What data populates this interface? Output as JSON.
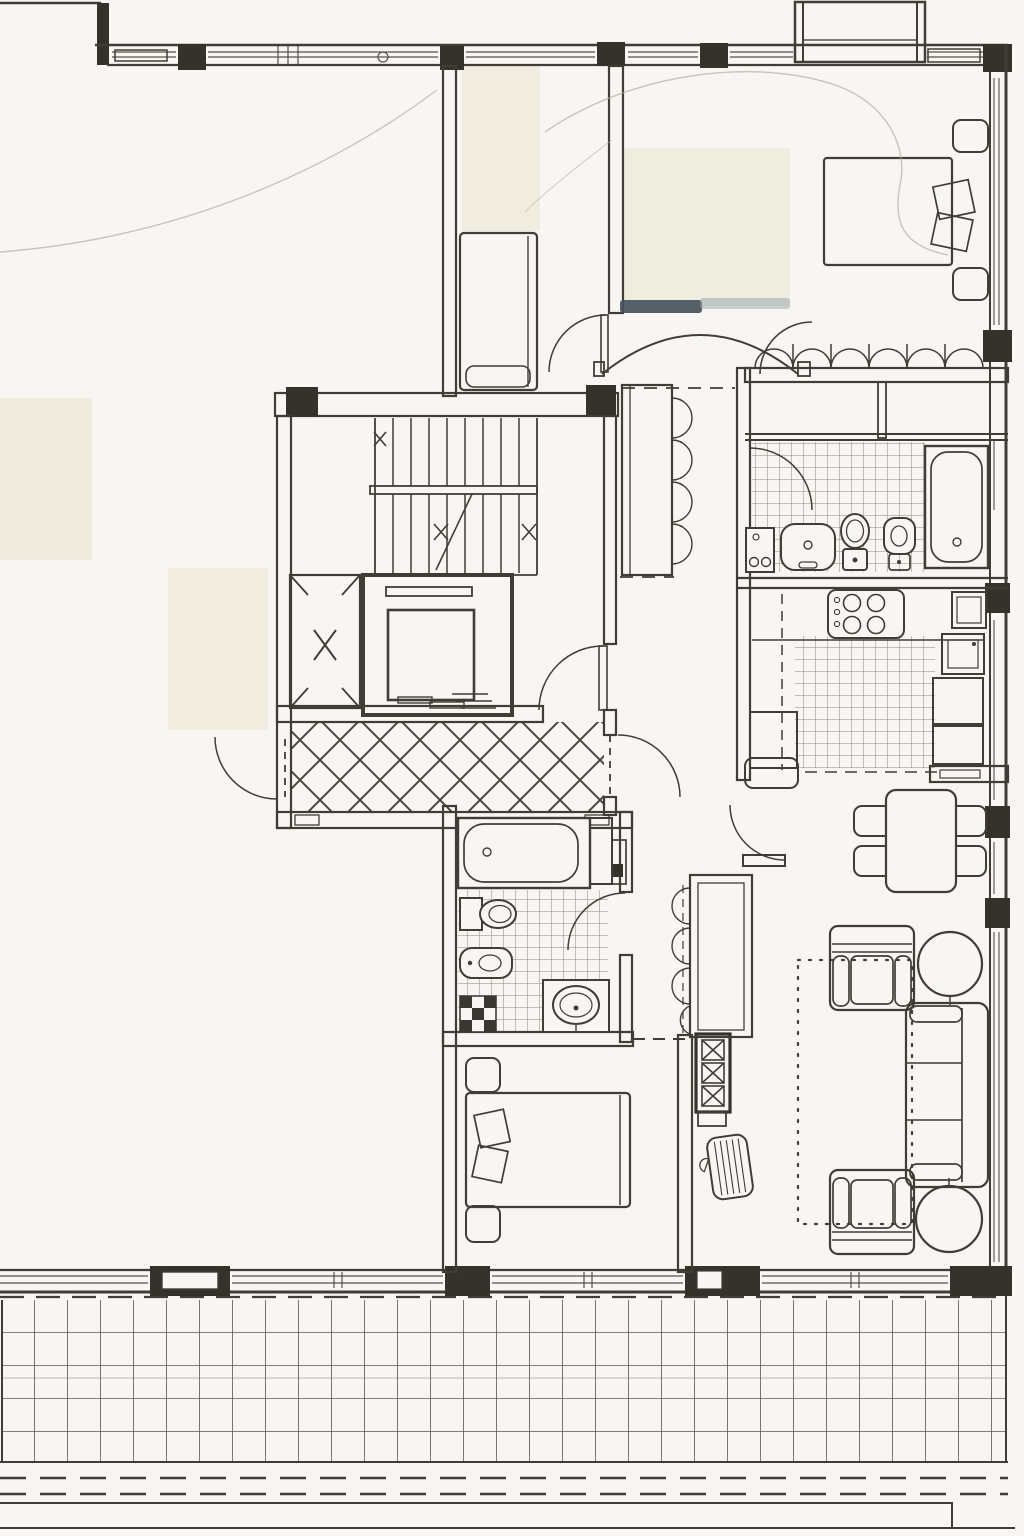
{
  "document": {
    "type": "architectural-floor-plan",
    "style": "black-and-white scanned blueprint, no text labels visible",
    "visible_text": [],
    "orientation": "apartment on right side, neighbouring unit erased to blank paper on left, tiled terrace across bottom"
  },
  "palette": {
    "paper": "#f7f6f2",
    "ink": "#413d36",
    "wall_fill": "#35322b",
    "tile_line": "#8a8578",
    "terrace_line": "#5c5850",
    "artifact_beige": "#edeadb",
    "smear_dark": "#44505b",
    "smear_light": "#98a2a6",
    "pencil_faint": "#b3afa3"
  },
  "rooms": [
    {
      "name": "stair-lobby",
      "floor": "diamond crosshatch tiles",
      "doors": 3
    },
    {
      "name": "staircase",
      "flights": 2,
      "treads_per_flight": 8,
      "landing": 1
    },
    {
      "name": "elevator",
      "parts": [
        "shaft",
        "car",
        "sliding-door",
        "counterweight",
        "sill-steps"
      ]
    },
    {
      "name": "upper-left-room",
      "furniture": [
        "wardrobe-or-bed"
      ]
    },
    {
      "name": "upper-right-bedroom",
      "furniture": [
        "double-bed",
        "two-pillows",
        "two-nightstands",
        "open-closet-hanging-rail"
      ]
    },
    {
      "name": "upper-bathroom",
      "fixtures": [
        "bathtub",
        "toilet",
        "bidet",
        "washbasin",
        "washing-machine"
      ],
      "floor": "small square tiles"
    },
    {
      "name": "kitchen",
      "fixtures": [
        "cooktop-4-burners",
        "sink",
        "fridge",
        "counter",
        "overhead-cabinet-dashed"
      ],
      "floor": "small square tiles"
    },
    {
      "name": "dining-area",
      "furniture": [
        "table",
        "four-chairs",
        "sideboard"
      ]
    },
    {
      "name": "living-room",
      "furniture": [
        "sofa-3-seats",
        "two-armchairs",
        "two-round-side-tables",
        "tv-unit-3-bays",
        "magazine-rack",
        "dotted-rug"
      ]
    },
    {
      "name": "lower-bathroom",
      "fixtures": [
        "bathtub",
        "toilet",
        "bidet",
        "vanity-washbasin",
        "checker-drain",
        "water-heater"
      ],
      "floor": "small square tiles"
    },
    {
      "name": "lower-bedroom",
      "furniture": [
        "double-bed",
        "two-pillows",
        "two-nightstands"
      ]
    },
    {
      "name": "hallway",
      "furniture": [
        "closet-with-hanging-rail"
      ]
    },
    {
      "name": "corridor",
      "furniture": [
        "built-in-wardrobe"
      ],
      "feature": "wide-arched-passage"
    },
    {
      "name": "terrace",
      "floor": "large square tile grid",
      "boundary": "double dashed edge lines"
    }
  ],
  "counts": {
    "door-swing-arcs": 8,
    "dining-chairs": 4,
    "cooktop-burners": 4,
    "closet-rail-arcs-bedroom": 6,
    "wardrobe-arcs-corridor": 4,
    "wardrobe-arcs-hall-closet": 4,
    "window-pillars-top-wall": 5
  }
}
